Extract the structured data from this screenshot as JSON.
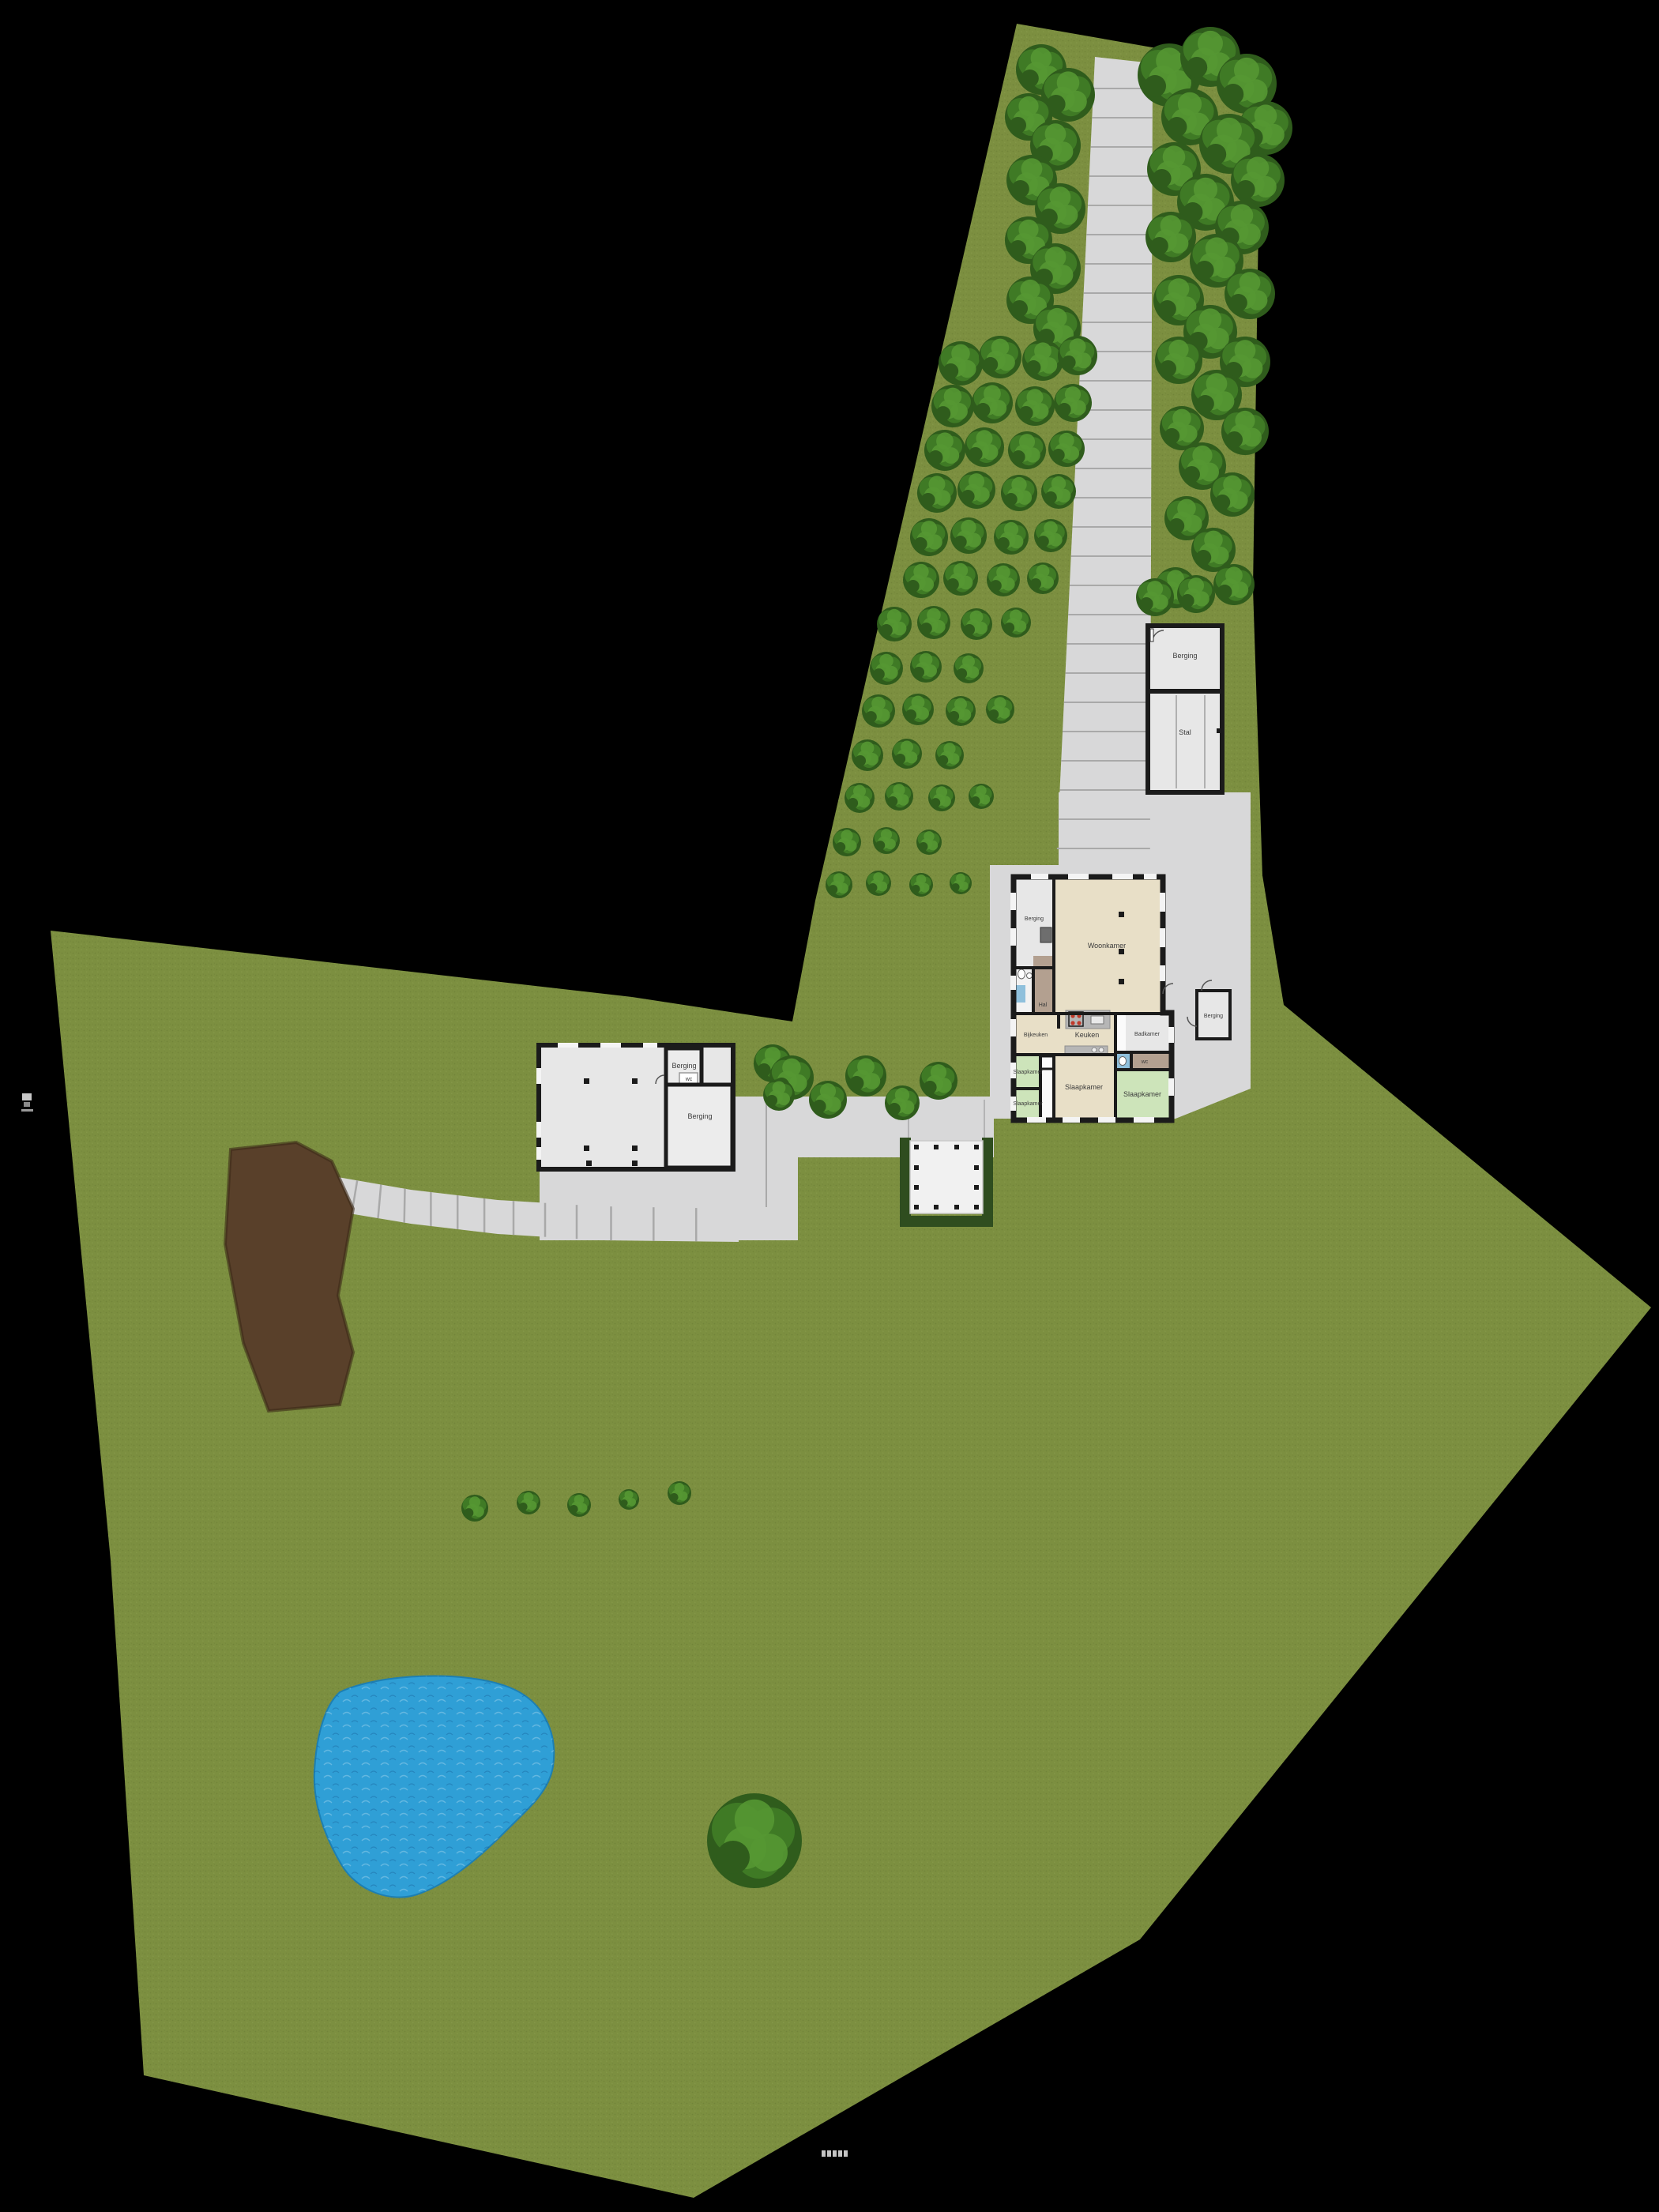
{
  "plan": {
    "type": "site-plan-top-view",
    "rooms": {
      "woonkamer": "Woonkamer",
      "berging_tl": "Berging",
      "hal": "Hal",
      "bijkeuken": "Bijkeuken",
      "keuken": "Keuken",
      "badkamer": "Badkamer",
      "wc": "wc",
      "slaapkamer_mid": "Slaapkamer",
      "slaapkamer_l1": "Slaapkamer",
      "slaapkamer_l2": "Slaapkamer",
      "slaapkamer_r": "Slaapkamer",
      "berging_detached": "Berging"
    },
    "outbuilding": {
      "berging": "Berging",
      "stal": "Stal"
    },
    "shed": {
      "berging_top": "Berging",
      "wc": "wc",
      "berging_main": "Berging"
    }
  },
  "colors": {
    "background": "#000000",
    "grass": "#7c8f40",
    "hedge": "#2f4d1f",
    "paving": "#d8d8d9",
    "paving_seam": "#a9a9a9",
    "wall": "#1b1b1b",
    "room_gray": "#e7e7e7",
    "room_beige": "#e8dfc7",
    "room_green": "#cde4ba",
    "room_brown": "#b3a090",
    "room_blue": "#8fc0dc",
    "counter": "#b6b6b6",
    "stove_red": "#c03a2b",
    "appliance_dark": "#6e6e6e",
    "dirt": "#59402a",
    "dirt_edge": "#3c2a18",
    "water": "#2f9fd6",
    "water_light": "#6ac4ea",
    "tree_dark": "#2f5c1c",
    "tree_mid": "#3f7a25",
    "tree_light": "#559733",
    "pergola": "#f1f1f1",
    "white": "#ffffff"
  }
}
